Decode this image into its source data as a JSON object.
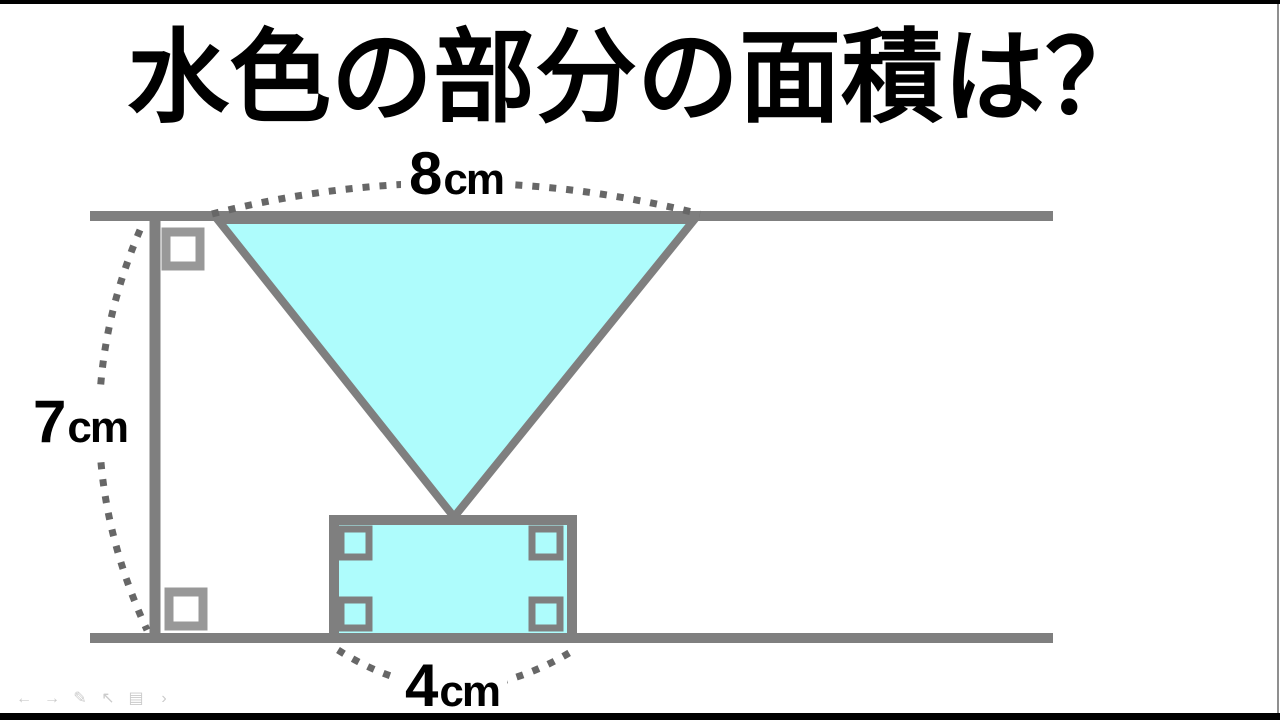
{
  "title": "水色の部分の面積は？",
  "dimensions": {
    "top": {
      "value": "8",
      "unit": "cm"
    },
    "left": {
      "value": "7",
      "unit": "cm"
    },
    "bottom": {
      "value": "4",
      "unit": "cm"
    }
  },
  "colors": {
    "shape_fill": "#aefcfc",
    "line": "#7f7f7f",
    "dotted": "#676767",
    "marker": "#989898",
    "title_text": "#000000",
    "letterbox": "#000000",
    "toolbar_icon": "#cbcbcb"
  },
  "toolbar": {
    "icons": [
      {
        "name": "previous-slide",
        "glyph": "←"
      },
      {
        "name": "next-slide",
        "glyph": "→"
      },
      {
        "name": "pen",
        "glyph": "✎"
      },
      {
        "name": "cursor",
        "glyph": "↖"
      },
      {
        "name": "slide-overview",
        "glyph": "▤"
      },
      {
        "name": "more",
        "glyph": "›"
      }
    ]
  }
}
